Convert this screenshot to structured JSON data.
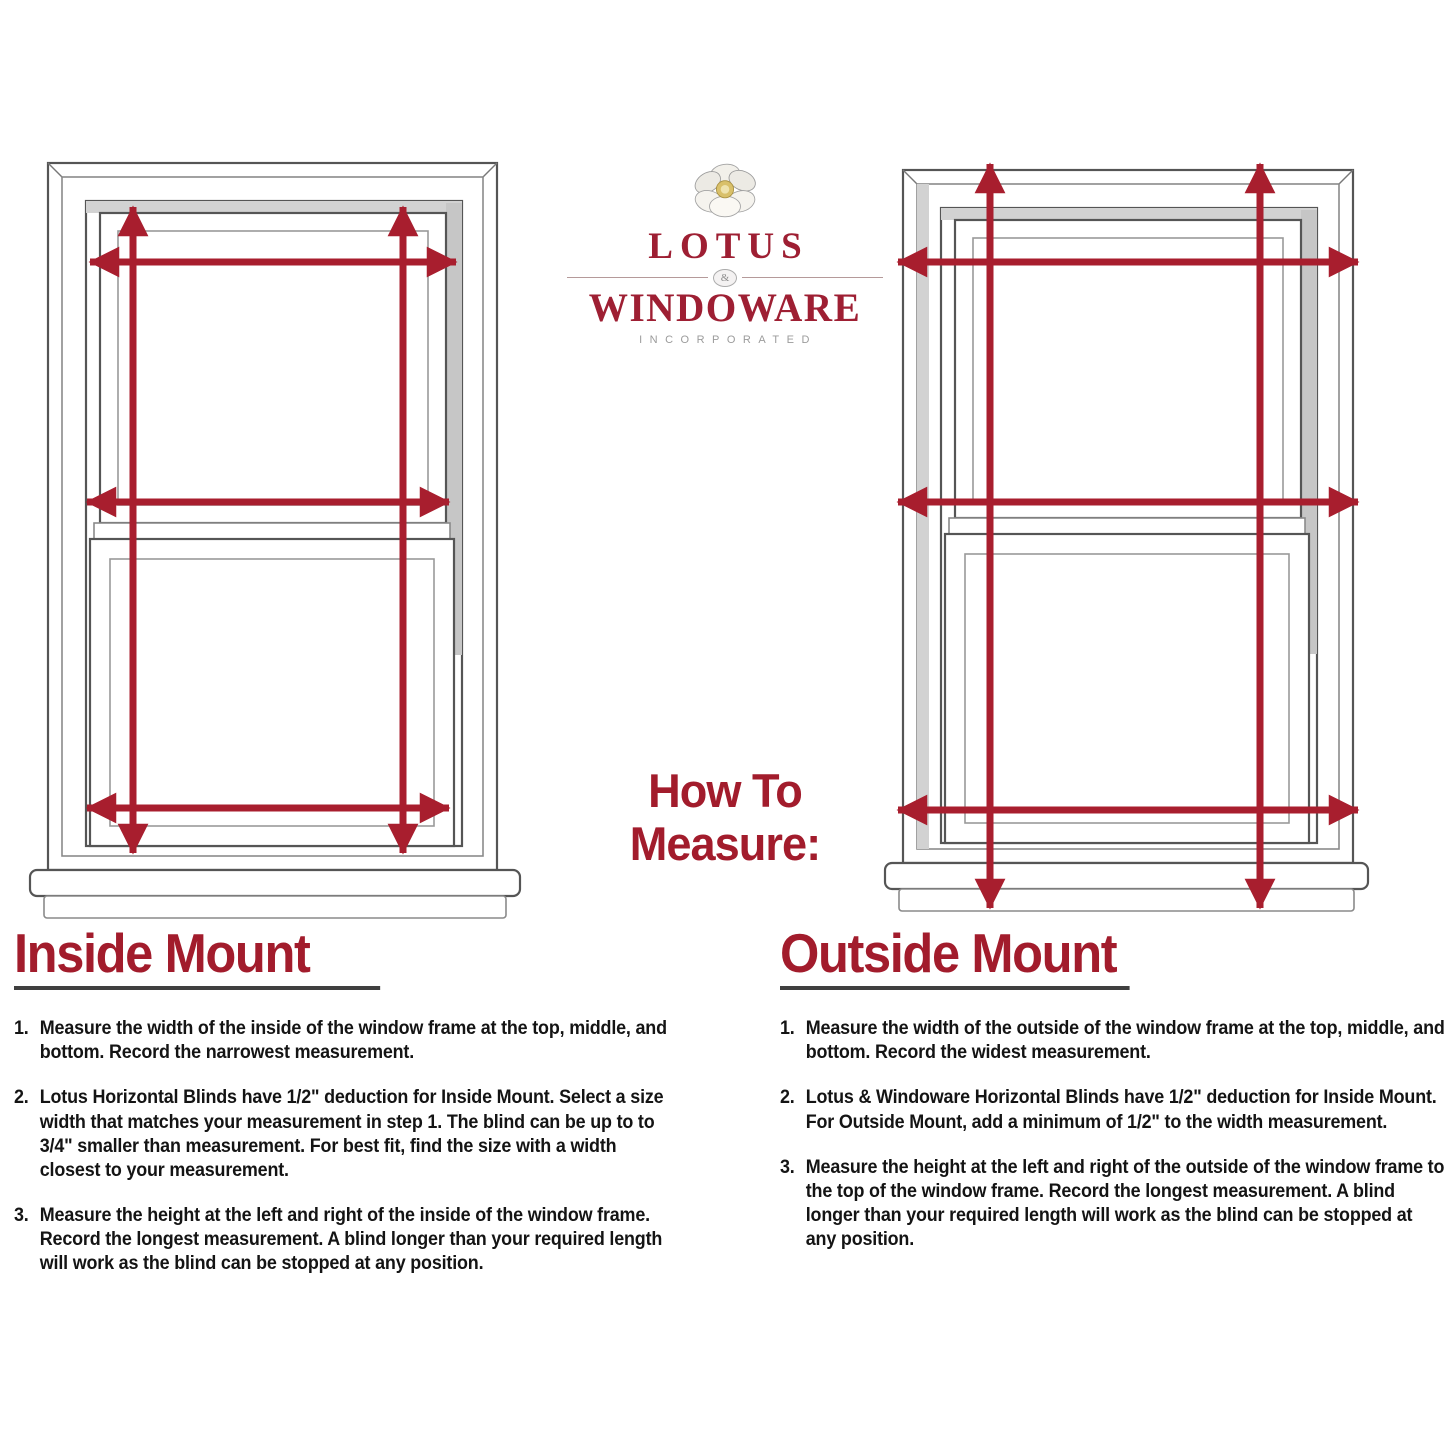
{
  "logo": {
    "flower_icon": "lotus-flower-icon",
    "name_top": "LOTUS",
    "ampersand": "&",
    "name_bottom": "WINDOWARE",
    "tagline": "INCORPORATED",
    "text_color": "#9e1f33",
    "tagline_color": "#9b9b9b"
  },
  "center_heading": {
    "line1": "How To",
    "line2": "Measure:",
    "color": "#a21c2c"
  },
  "diagram": {
    "arrow_color": "#a81e2e",
    "left_window": "inside-mount-window",
    "right_window": "outside-mount-window"
  },
  "inside_mount": {
    "title": "Inside Mount",
    "items": [
      {
        "num": "1.",
        "text": "Measure the width of the inside of the window frame at the top, middle, and bottom. Record the narrowest measurement."
      },
      {
        "num": "2.",
        "text": "Lotus Horizontal Blinds have 1/2\" deduction for Inside Mount. Select a size width that matches your measurement in step 1.  The blind can be up to to 3/4\" smaller than measurement.  For best fit, find the size with a width closest to your measurement."
      },
      {
        "num": "3.",
        "text": "Measure the height at the left and right of the inside of the window frame. Record the longest measurement. A blind longer than your required length will work as the blind can be stopped at any position."
      }
    ]
  },
  "outside_mount": {
    "title": "Outside Mount",
    "items": [
      {
        "num": "1.",
        "text": "Measure the width of the outside of the window frame at the top, middle, and bottom. Record the widest measurement."
      },
      {
        "num": "2.",
        "text": "Lotus & Windoware Horizontal Blinds have 1/2\" deduction for Inside Mount. For Outside Mount, add a minimum of 1/2\" to the width measurement."
      },
      {
        "num": "3.",
        "text": "Measure the height at the left and right of the outside of the window frame to the top of the window frame. Record the longest measurement. A blind longer than your required length will work as the blind can be stopped at any position."
      }
    ]
  }
}
